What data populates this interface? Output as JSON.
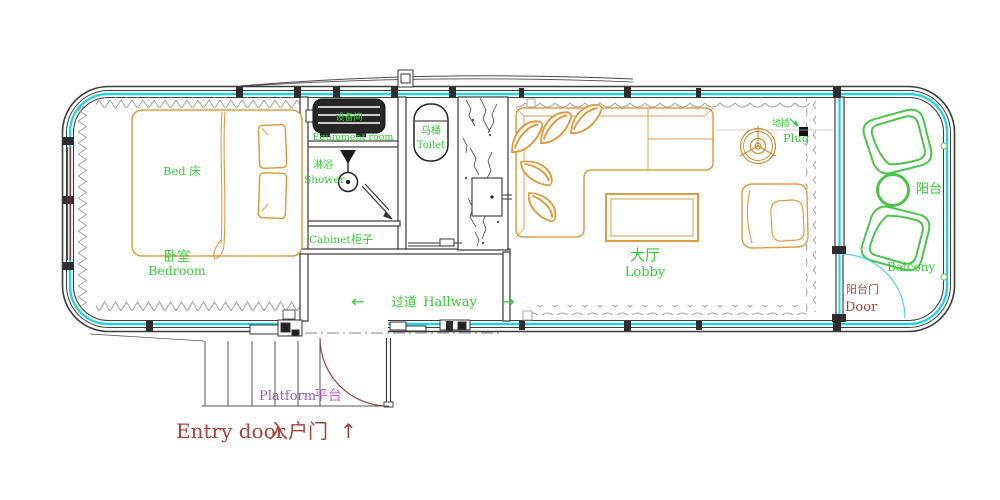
{
  "meta": {
    "type": "tiny-house floor plan"
  },
  "colors": {
    "shell_line": "#3d3d3d",
    "window_glass": "#25d2e2",
    "insulation_gray": "#a0a0a0",
    "wood_furniture": "#dd9d44",
    "label_green": "#35cb35",
    "balcony_green": "#4cc44c",
    "label_red": "#a8413c",
    "label_purple": "#9b59b6",
    "label_magenta": "#cf5fd1"
  },
  "rooms": {
    "bedroom": {
      "zh": "卧室",
      "en": "Bedroom",
      "bed": "Bed 床"
    },
    "equipment": {
      "zh": "设备间",
      "en": "Equipment room"
    },
    "shower": {
      "zh": "淋浴",
      "en": "Shower"
    },
    "cabinet": {
      "en": "Cabinet",
      "zh": "柜子"
    },
    "toilet": {
      "zh": "马桶",
      "en": "Toilet"
    },
    "lobby": {
      "zh": "大厅",
      "en": "Lobby"
    },
    "hallway": {
      "zh": "过道",
      "en": "Hallway",
      "arrow_left": "←",
      "arrow_right": "→"
    },
    "balcony": {
      "zh": "阳台",
      "en": "Balcony"
    },
    "balcony_door": {
      "zh": "阳台门",
      "en": "Door"
    },
    "plug": {
      "zh": "地插",
      "en": "Plug"
    },
    "platform": {
      "en": "Platform",
      "zh": "平台"
    },
    "entry_door": {
      "en": "Entry door",
      "zh": "入户门",
      "arrow_up": "↑"
    }
  }
}
